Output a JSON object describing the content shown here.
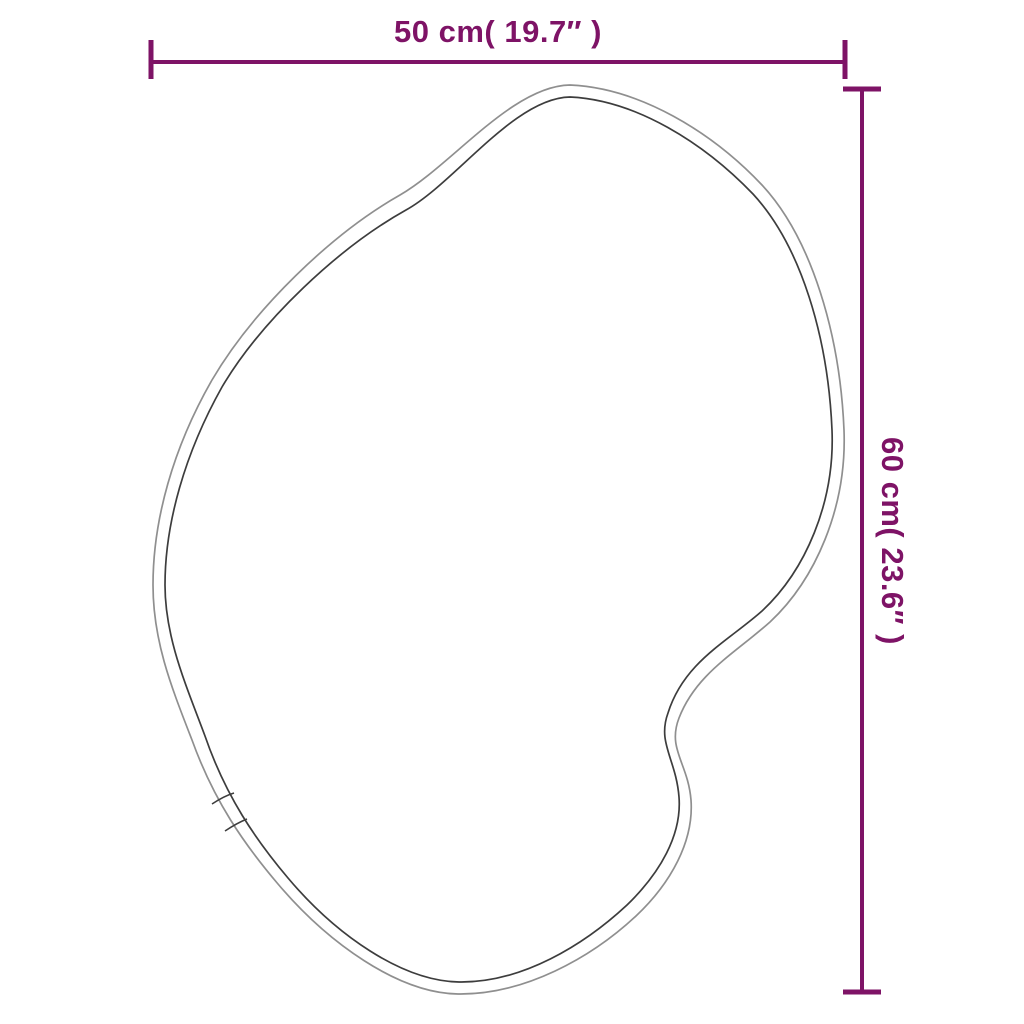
{
  "diagram": {
    "subject": "irregular organic blob-shaped mirror outline with dimension arrows",
    "width_label": "50 cm( 19.7″ )",
    "height_label": "60 cm( 23.6″ )",
    "width_cm": 50,
    "width_inches": 19.7,
    "height_cm": 60,
    "height_inches": 23.6
  },
  "colors": {
    "dimension": "#7E1366",
    "outline_outer": "#8f8f8f",
    "outline_inner": "#3d3d3d",
    "background": "#ffffff"
  }
}
